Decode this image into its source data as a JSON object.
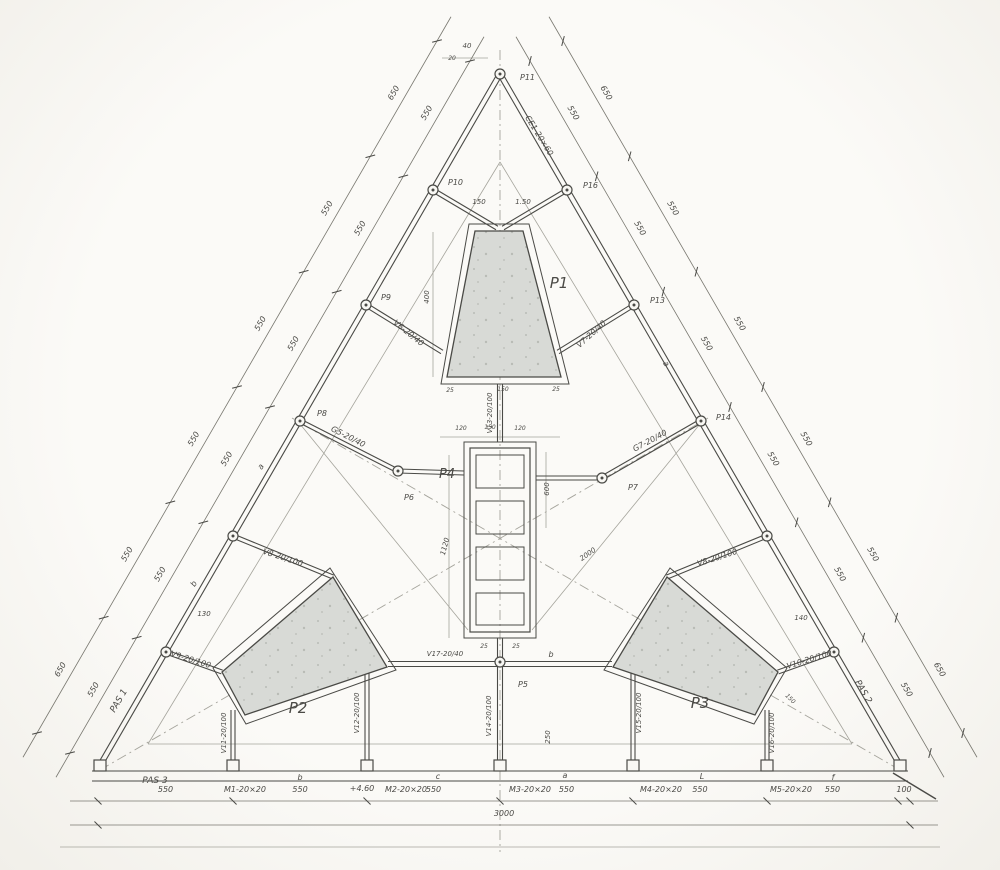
{
  "meta": {
    "title": "triangular-structural-floor-plan",
    "paper": "#f8f7f3",
    "ink": "#4a4a46",
    "dim": "#78776f",
    "pencil": "#a5a49c",
    "core_fill": "#d8dad6",
    "speck": "#b9bcb6",
    "width": 1000,
    "height": 870
  },
  "cores": [
    {
      "name": "core-p1",
      "label": "P1",
      "label_x": 559,
      "label_y": 288,
      "label_s": 15,
      "outer": [
        [
          469,
          224
        ],
        [
          529,
          224
        ],
        [
          569,
          384
        ],
        [
          441,
          384
        ]
      ],
      "inner": [
        [
          475,
          231
        ],
        [
          523,
          231
        ],
        [
          561,
          377
        ],
        [
          447,
          377
        ]
      ]
    },
    {
      "name": "core-p2",
      "label": "P2",
      "label_x": 298,
      "label_y": 713,
      "label_s": 15,
      "outer": [
        [
          330,
          568
        ],
        [
          396,
          670
        ],
        [
          246,
          724
        ],
        [
          213,
          668
        ]
      ],
      "inner": [
        [
          333,
          577
        ],
        [
          387,
          667
        ],
        [
          245,
          715
        ],
        [
          222,
          672
        ]
      ]
    },
    {
      "name": "core-p3",
      "label": "P3",
      "label_x": 700,
      "label_y": 708,
      "label_s": 15,
      "outer": [
        [
          670,
          568
        ],
        [
          604,
          670
        ],
        [
          754,
          724
        ],
        [
          787,
          668
        ]
      ],
      "inner": [
        [
          667,
          577
        ],
        [
          613,
          667
        ],
        [
          755,
          715
        ],
        [
          778,
          672
        ]
      ]
    }
  ],
  "shaft": {
    "name": "core-p4",
    "label": "P4",
    "label_x": 447,
    "label_y": 478,
    "label_s": 13,
    "outer": [
      464,
      442,
      72,
      196
    ],
    "wall": [
      470,
      448,
      60,
      184
    ],
    "cells": [
      [
        476,
        455,
        48,
        33
      ],
      [
        476,
        501,
        48,
        33
      ],
      [
        476,
        547,
        48,
        33
      ],
      [
        476,
        593,
        48,
        32
      ]
    ]
  },
  "beams": [
    [
      500,
      74,
      99,
      767,
      5
    ],
    [
      500,
      74,
      901,
      767,
      5
    ],
    [
      92,
      776,
      908,
      776,
      10
    ],
    [
      433,
      190,
      497,
      228,
      4
    ],
    [
      567,
      190,
      503,
      228,
      4
    ],
    [
      366,
      305,
      442,
      352,
      4
    ],
    [
      634,
      305,
      558,
      352,
      4
    ],
    [
      300,
      421,
      398,
      471,
      4
    ],
    [
      701,
      421,
      602,
      478,
      4
    ],
    [
      398,
      471,
      464,
      473,
      4
    ],
    [
      536,
      478,
      602,
      478,
      4
    ],
    [
      233,
      536,
      333,
      577,
      4
    ],
    [
      767,
      536,
      667,
      577,
      4
    ],
    [
      166,
      652,
      222,
      672,
      4
    ],
    [
      834,
      652,
      778,
      672,
      4
    ],
    [
      500,
      384,
      500,
      442,
      5
    ],
    [
      500,
      638,
      500,
      762,
      5
    ],
    [
      388,
      664,
      612,
      664,
      5
    ],
    [
      233,
      710,
      233,
      760,
      4
    ],
    [
      367,
      668,
      367,
      760,
      4
    ],
    [
      633,
      668,
      633,
      760,
      4
    ],
    [
      767,
      710,
      767,
      760,
      4
    ]
  ],
  "axis_lines": [
    [
      500,
      50,
      500,
      852
    ],
    [
      100,
      770,
      708,
      418
    ],
    [
      900,
      770,
      292,
      418
    ]
  ],
  "pencil_lines": [
    [
      500,
      162,
      148,
      744
    ],
    [
      500,
      162,
      852,
      744
    ],
    [
      148,
      744,
      852,
      744
    ],
    [
      60,
      847,
      940,
      847
    ],
    [
      532,
      630,
      700,
      424
    ],
    [
      468,
      630,
      300,
      424
    ],
    [
      449,
      455,
      449,
      638
    ],
    [
      546,
      452,
      546,
      528
    ],
    [
      440,
      437,
      560,
      437
    ],
    [
      442,
      58,
      488,
      58
    ],
    [
      433,
      232,
      433,
      377
    ]
  ],
  "ink_lines": [
    [
      893,
      773,
      936,
      799
    ]
  ],
  "nodes": [
    [
      500,
      74
    ],
    [
      433,
      190
    ],
    [
      567,
      190
    ],
    [
      366,
      305
    ],
    [
      634,
      305
    ],
    [
      300,
      421
    ],
    [
      701,
      421
    ],
    [
      233,
      536
    ],
    [
      767,
      536
    ],
    [
      166,
      652
    ],
    [
      834,
      652
    ],
    [
      398,
      471
    ],
    [
      602,
      478
    ],
    [
      500,
      662
    ]
  ],
  "columns": [
    [
      233
    ],
    [
      367
    ],
    [
      500
    ],
    [
      633
    ],
    [
      767
    ],
    [
      100
    ],
    [
      900
    ]
  ],
  "chains": [
    {
      "name": "dim-left-inner",
      "x1": 470,
      "y1": 61,
      "x2": 70,
      "y2": 753,
      "rot": -60,
      "side": -1,
      "labels": [
        "550",
        "550",
        "550",
        "550",
        "550",
        "550"
      ]
    },
    {
      "name": "dim-left-outer",
      "x1": 437,
      "y1": 41,
      "x2": 37,
      "y2": 733,
      "rot": -60,
      "side": -1,
      "labels": [
        "650",
        "550",
        "550",
        "550",
        "550",
        "650"
      ]
    },
    {
      "name": "dim-right-inner",
      "x1": 530,
      "y1": 61,
      "x2": 930,
      "y2": 753,
      "rot": 60,
      "side": 1,
      "labels": [
        "550",
        "550",
        "550",
        "550",
        "550",
        "550"
      ]
    },
    {
      "name": "dim-right-outer",
      "x1": 563,
      "y1": 41,
      "x2": 963,
      "y2": 733,
      "rot": 60,
      "side": 1,
      "labels": [
        "650",
        "550",
        "550",
        "550",
        "550",
        "650"
      ]
    },
    {
      "name": "dim-bottom-bays",
      "x1": 98,
      "y1": 801,
      "x2": 910,
      "y2": 801,
      "rot": 0,
      "side": 1,
      "fracs": [
        0,
        0.1663,
        0.3313,
        0.4951,
        0.6588,
        0.8239,
        0.9852,
        1
      ],
      "labels": [
        "550",
        "550",
        "550",
        "550",
        "550",
        "550",
        "100"
      ]
    },
    {
      "name": "dim-bottom-total",
      "x1": 98,
      "y1": 825,
      "x2": 910,
      "y2": 825,
      "rot": 0,
      "side": 1,
      "labels": [
        "3000"
      ]
    }
  ],
  "labels": [
    {
      "t": "P11",
      "x": 520,
      "y": 80,
      "r": 0,
      "s": 8,
      "a": "start"
    },
    {
      "t": "P10",
      "x": 448,
      "y": 185,
      "r": 0,
      "s": 8,
      "a": "start"
    },
    {
      "t": "P16",
      "x": 583,
      "y": 188,
      "r": 0,
      "s": 8,
      "a": "start"
    },
    {
      "t": "P9",
      "x": 381,
      "y": 300,
      "r": 0,
      "s": 8,
      "a": "start"
    },
    {
      "t": "P13",
      "x": 650,
      "y": 303,
      "r": 0,
      "s": 8,
      "a": "start"
    },
    {
      "t": "P8",
      "x": 317,
      "y": 416,
      "r": 0,
      "s": 8,
      "a": "start"
    },
    {
      "t": "P14",
      "x": 716,
      "y": 420,
      "r": 0,
      "s": 8,
      "a": "start"
    },
    {
      "t": "P6",
      "x": 404,
      "y": 500,
      "r": 0,
      "s": 8,
      "a": "start"
    },
    {
      "t": "P7",
      "x": 628,
      "y": 490,
      "r": 0,
      "s": 8,
      "a": "start"
    },
    {
      "t": "P5",
      "x": 518,
      "y": 687,
      "r": 0,
      "s": 8,
      "a": "start"
    },
    {
      "t": "CE1-20×60",
      "x": 537,
      "y": 137,
      "r": 58,
      "s": 8
    },
    {
      "t": "V6-20/40",
      "x": 407,
      "y": 335,
      "r": 39,
      "s": 8
    },
    {
      "t": "V7-20/40",
      "x": 593,
      "y": 336,
      "r": -42,
      "s": 8
    },
    {
      "t": "G5-20/40",
      "x": 347,
      "y": 439,
      "r": 27,
      "s": 8
    },
    {
      "t": "G7-20/40",
      "x": 651,
      "y": 443,
      "r": -28,
      "s": 8
    },
    {
      "t": "V8-20/100",
      "x": 282,
      "y": 560,
      "r": 18,
      "s": 8
    },
    {
      "t": "V8-20/100",
      "x": 718,
      "y": 560,
      "r": -18,
      "s": 8
    },
    {
      "t": "V9-20/100",
      "x": 190,
      "y": 662,
      "r": 17,
      "s": 8
    },
    {
      "t": "V10-20/100",
      "x": 810,
      "y": 662,
      "r": -17,
      "s": 8
    },
    {
      "t": "V17-20/40",
      "x": 445,
      "y": 656,
      "r": 0,
      "s": 7
    },
    {
      "t": "V13-20/100",
      "x": 492,
      "y": 413,
      "r": -90,
      "s": 7
    },
    {
      "t": "V14-20/100",
      "x": 491,
      "y": 716,
      "r": -90,
      "s": 7
    },
    {
      "t": "V11-20/100",
      "x": 226,
      "y": 733,
      "r": -90,
      "s": 7
    },
    {
      "t": "V12-20/100",
      "x": 359,
      "y": 713,
      "r": -90,
      "s": 7
    },
    {
      "t": "V15-20/100",
      "x": 641,
      "y": 713,
      "r": -90,
      "s": 7
    },
    {
      "t": "V16-20/100",
      "x": 774,
      "y": 733,
      "r": -90,
      "s": 7
    },
    {
      "t": "b",
      "x": 551,
      "y": 657,
      "r": 0,
      "s": 8
    },
    {
      "t": "b",
      "x": 300,
      "y": 780,
      "r": 0,
      "s": 8
    },
    {
      "t": "c",
      "x": 438,
      "y": 779,
      "r": 0,
      "s": 8
    },
    {
      "t": "a",
      "x": 565,
      "y": 778,
      "r": 0,
      "s": 8
    },
    {
      "t": "L",
      "x": 702,
      "y": 779,
      "r": 0,
      "s": 8
    },
    {
      "t": "f",
      "x": 833,
      "y": 780,
      "r": 0,
      "s": 8
    },
    {
      "t": "a",
      "x": 263,
      "y": 468,
      "r": -60,
      "s": 8
    },
    {
      "t": "b",
      "x": 196,
      "y": 585,
      "r": -60,
      "s": 8
    },
    {
      "t": "a",
      "x": 664,
      "y": 365,
      "r": 60,
      "s": 8
    },
    {
      "t": "PAS 1",
      "x": 121,
      "y": 702,
      "r": -60,
      "s": 9
    },
    {
      "t": "PAS 2",
      "x": 861,
      "y": 693,
      "r": 60,
      "s": 9
    },
    {
      "t": "PAS 3",
      "x": 155,
      "y": 783,
      "r": 0,
      "s": 9
    },
    {
      "t": "M1-20×20",
      "x": 245,
      "y": 792,
      "r": 0,
      "s": 8
    },
    {
      "t": "+4.60",
      "x": 362,
      "y": 791,
      "r": 0,
      "s": 8
    },
    {
      "t": "M2-20×20",
      "x": 406,
      "y": 792,
      "r": 0,
      "s": 8
    },
    {
      "t": "M3-20×20",
      "x": 530,
      "y": 792,
      "r": 0,
      "s": 8
    },
    {
      "t": "M4-20×20",
      "x": 661,
      "y": 792,
      "r": 0,
      "s": 8
    },
    {
      "t": "M5-20×20",
      "x": 791,
      "y": 792,
      "r": 0,
      "s": 8
    },
    {
      "t": "40",
      "x": 467,
      "y": 48,
      "r": 0,
      "s": 7
    },
    {
      "t": "20",
      "x": 452,
      "y": 60,
      "r": 0,
      "s": 6
    },
    {
      "t": "150",
      "x": 479,
      "y": 204,
      "r": 0,
      "s": 7
    },
    {
      "t": "1.50",
      "x": 523,
      "y": 204,
      "r": 0,
      "s": 7
    },
    {
      "t": "400",
      "x": 429,
      "y": 297,
      "r": -90,
      "s": 7
    },
    {
      "t": "150",
      "x": 503,
      "y": 391,
      "r": 0,
      "s": 6
    },
    {
      "t": "25",
      "x": 450,
      "y": 392,
      "r": 0,
      "s": 6
    },
    {
      "t": "25",
      "x": 556,
      "y": 391,
      "r": 0,
      "s": 6
    },
    {
      "t": "120",
      "x": 461,
      "y": 430,
      "r": 0,
      "s": 6
    },
    {
      "t": "150",
      "x": 490,
      "y": 429,
      "r": 0,
      "s": 6
    },
    {
      "t": "120",
      "x": 520,
      "y": 430,
      "r": 0,
      "s": 6
    },
    {
      "t": "600",
      "x": 549,
      "y": 489,
      "r": -90,
      "s": 7
    },
    {
      "t": "1120",
      "x": 447,
      "y": 547,
      "r": -75,
      "s": 7
    },
    {
      "t": "2000",
      "x": 589,
      "y": 556,
      "r": -35,
      "s": 7
    },
    {
      "t": "25",
      "x": 484,
      "y": 648,
      "r": 0,
      "s": 6
    },
    {
      "t": "25",
      "x": 516,
      "y": 648,
      "r": 0,
      "s": 6
    },
    {
      "t": "250",
      "x": 550,
      "y": 737,
      "r": -90,
      "s": 7
    },
    {
      "t": "130",
      "x": 204,
      "y": 616,
      "r": 0,
      "s": 7
    },
    {
      "t": "140",
      "x": 801,
      "y": 620,
      "r": 0,
      "s": 7
    },
    {
      "t": "150",
      "x": 789,
      "y": 700,
      "r": 45,
      "s": 6
    }
  ]
}
